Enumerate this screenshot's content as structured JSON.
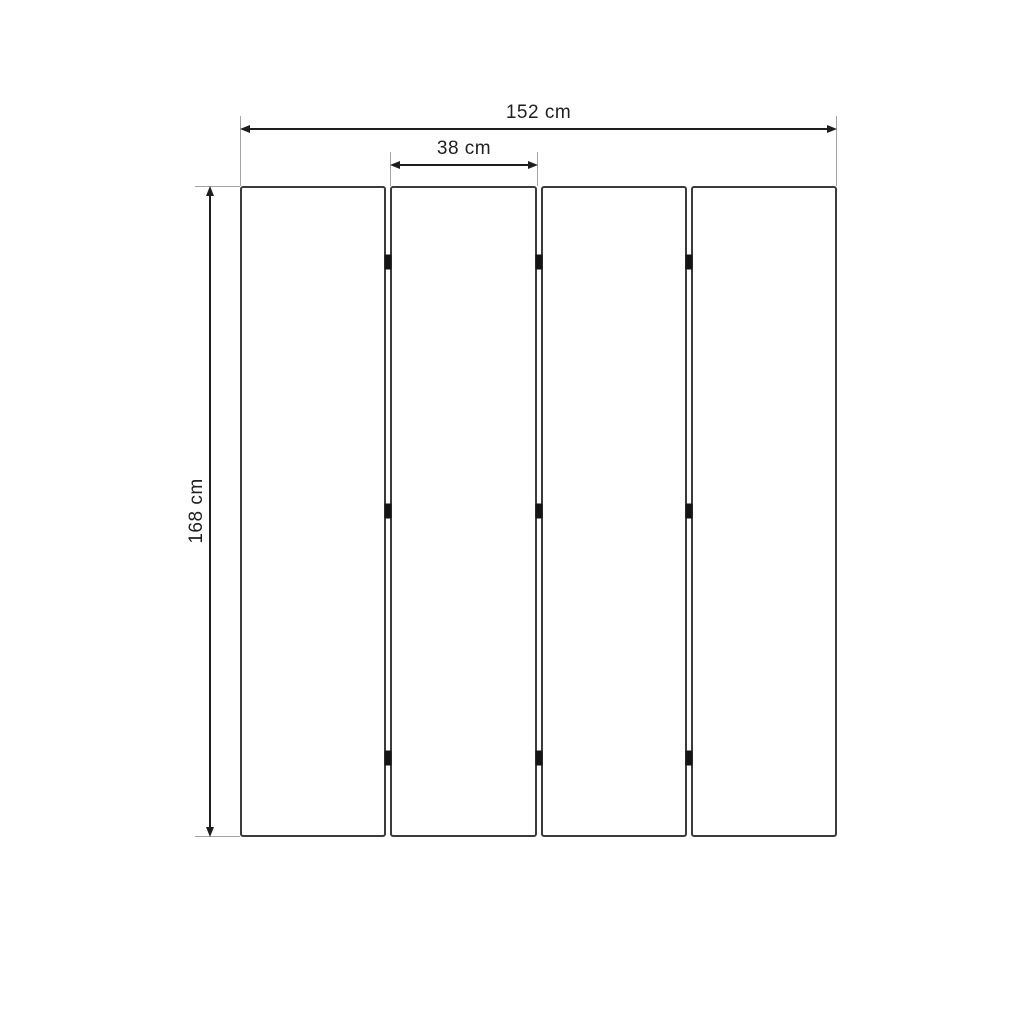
{
  "diagram": {
    "type": "technical-dimension-drawing",
    "subject": "four-panel folding screen, front view",
    "labels": {
      "total_width": "152 cm",
      "panel_width": "38 cm",
      "height": "168 cm"
    },
    "panel_count": 4,
    "hinge_rows": 3,
    "colors": {
      "background": "#ffffff",
      "panel_outline": "#3b3b3b",
      "dimension_line": "#1e1e1e",
      "extension_line": "#a3a3a3",
      "hinge": "#151515",
      "text": "#1f1f1f"
    }
  }
}
